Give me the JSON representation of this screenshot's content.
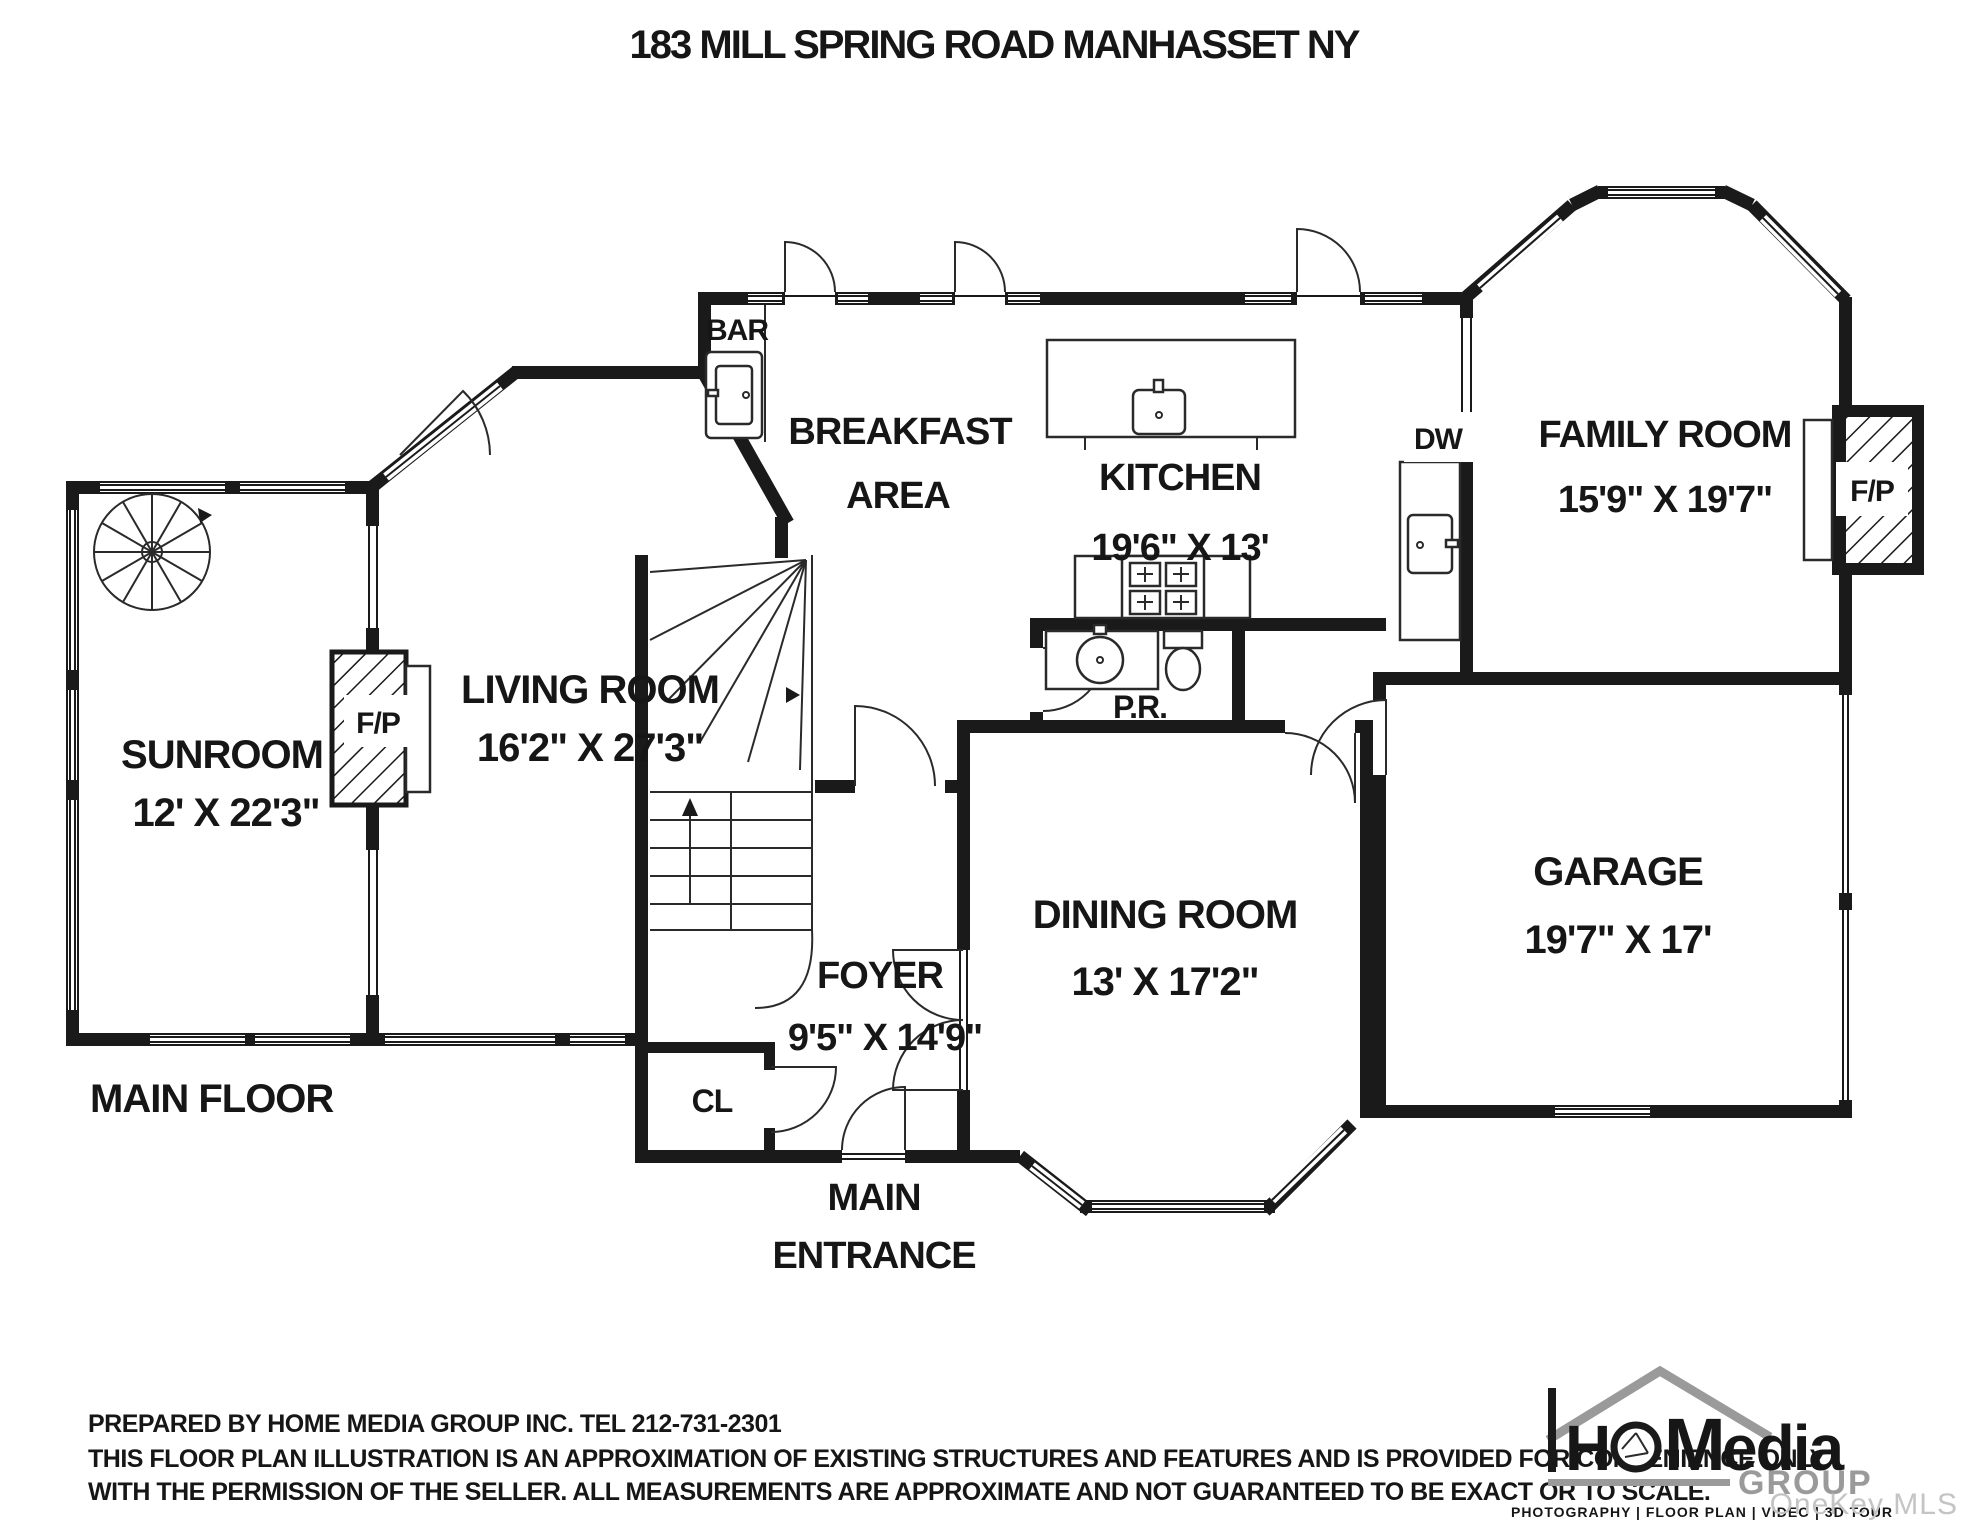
{
  "title": "183 MILL SPRING ROAD MANHASSET NY",
  "plan": {
    "rooms": {
      "sunroom": {
        "name": "SUNROOM",
        "dims": "12' X 22'3\""
      },
      "living": {
        "name": "LIVING ROOM",
        "dims": "16'2\" X 27'3\""
      },
      "breakfast": {
        "line1": "BREAKFAST",
        "line2": "AREA"
      },
      "kitchen": {
        "name": "KITCHEN",
        "dims": "19'6\" X 13'"
      },
      "family": {
        "name": "FAMILY ROOM",
        "dims": "15'9\" X 19'7\""
      },
      "dining": {
        "name": "DINING ROOM",
        "dims": "13' X 17'2\""
      },
      "garage": {
        "name": "GARAGE",
        "dims": "19'7\" X 17'"
      },
      "foyer": {
        "name": "FOYER",
        "dims": "9'5\" X 14'9\""
      }
    },
    "labels": {
      "bar": "BAR",
      "dw": "DW",
      "cl": "CL",
      "pr": "P.R.",
      "fireplace": "F/P",
      "main_floor": "MAIN FLOOR",
      "main_entrance_line1": "MAIN",
      "main_entrance_line2": "ENTRANCE"
    }
  },
  "footer": {
    "prepared_by": "PREPARED BY  HOME MEDIA GROUP INC.  TEL 212-731-2301",
    "disclaimer_line1": "THIS FLOOR PLAN ILLUSTRATION IS AN APPROXIMATION OF EXISTING STRUCTURES AND FEATURES AND IS PROVIDED FOR CONVENIENCE ONLY",
    "disclaimer_line2": "WITH THE PERMISSION OF THE SELLER. ALL MEASUREMENTS ARE APPROXIMATE AND NOT GUARANTEED TO BE EXACT OR TO SCALE."
  },
  "logo": {
    "name_h": "H",
    "name_m": "M",
    "name_rest": "edia",
    "group": "GROUP",
    "tagline": "PHOTOGRAPHY | FLOOR PLAN | VIDEO | 3D TOUR"
  },
  "watermark": "OneKey MLS",
  "colors": {
    "ink": "#1a1a1a",
    "logo_gray": "#9a9a9a",
    "watermark": "#c4c4c4"
  }
}
